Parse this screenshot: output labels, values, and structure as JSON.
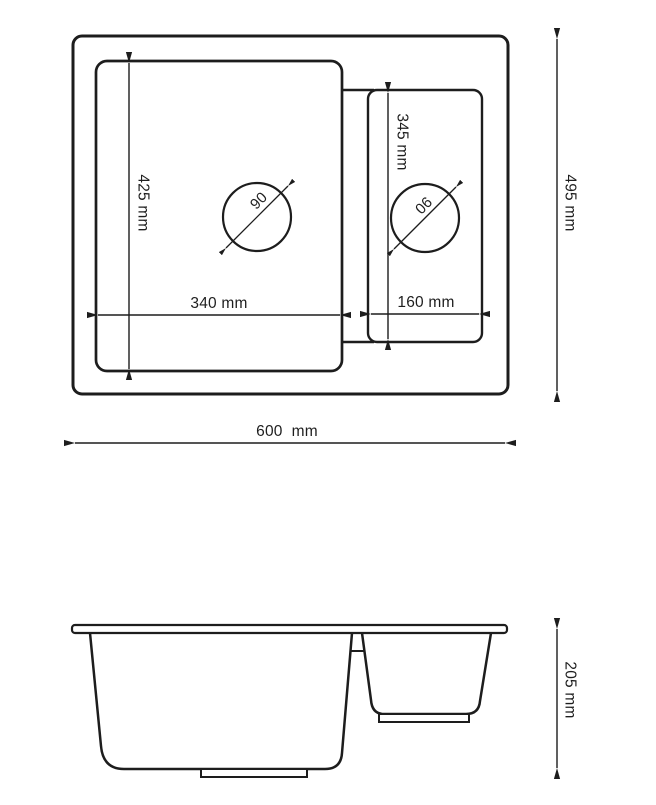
{
  "top_view": {
    "overall_width": {
      "label": "600  mm",
      "value_mm": 600
    },
    "overall_depth": {
      "label": "495 mm",
      "value_mm": 495
    },
    "main_bowl": {
      "inner_width": {
        "label": "340 mm",
        "value_mm": 340
      },
      "inner_depth": {
        "label": "425 mm",
        "value_mm": 425
      },
      "drain_diameter": {
        "label": "90",
        "value_mm": 90
      }
    },
    "half_bowl": {
      "inner_width": {
        "label": "160 mm",
        "value_mm": 160
      },
      "inner_depth": {
        "label": "345 mm",
        "value_mm": 345
      },
      "drain_diameter": {
        "label": "90",
        "value_mm": 90
      }
    }
  },
  "side_view": {
    "overall_height": {
      "label": "205 mm",
      "value_mm": 205
    }
  },
  "colors": {
    "line": "#1d1d1d",
    "background": "#ffffff"
  }
}
